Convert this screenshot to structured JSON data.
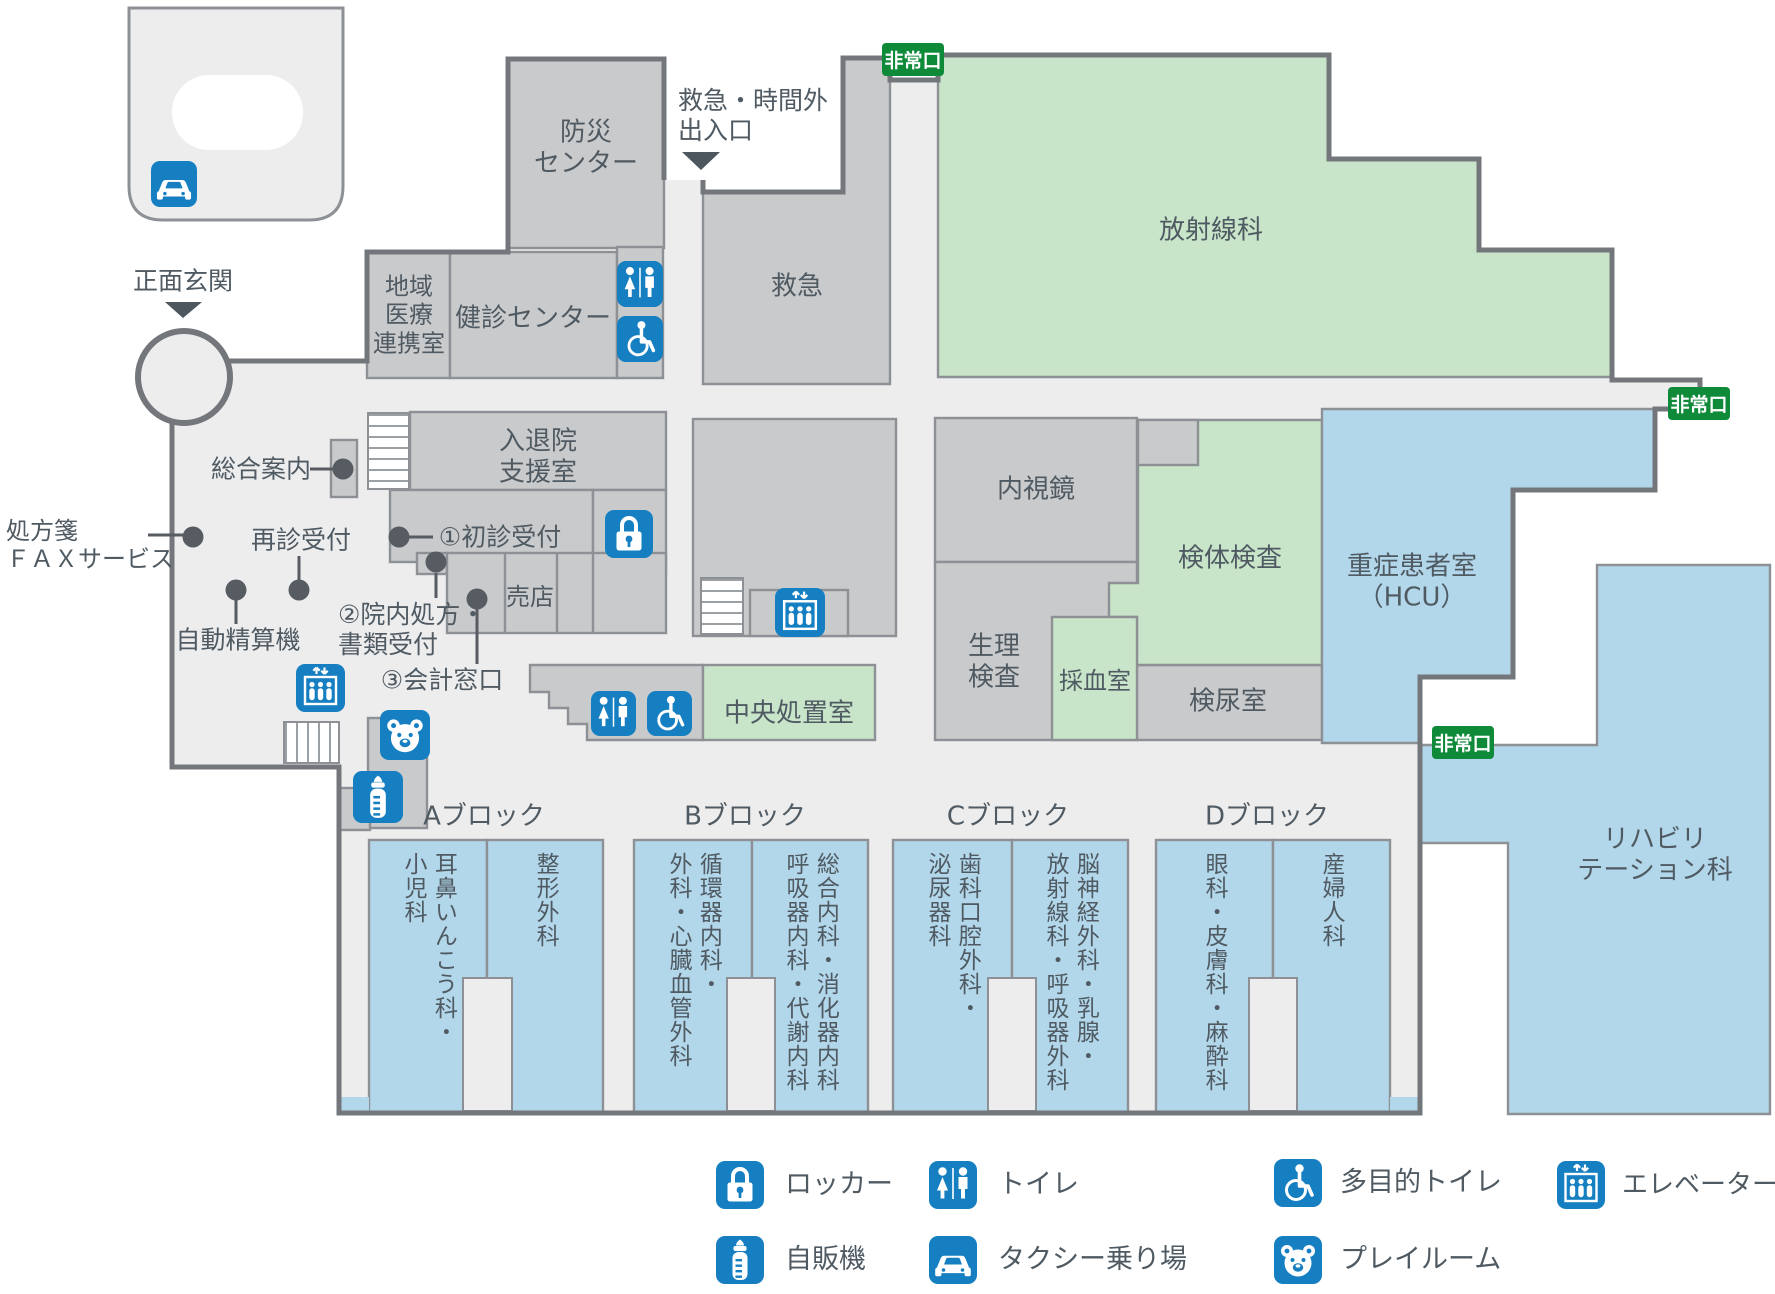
{
  "badge": {
    "exit": "非常口"
  },
  "entrances": {
    "main": {
      "label": "正面玄関"
    },
    "emergency": {
      "lines": [
        "救急・時間外",
        "出入口"
      ]
    }
  },
  "rooms": {
    "bousai": {
      "lines": [
        "防災",
        "センター"
      ]
    },
    "chiiki": {
      "lines": [
        "地域",
        "医療",
        "連携室"
      ]
    },
    "kenshin": {
      "label": "健診センター"
    },
    "kyukyu": {
      "label": "救急"
    },
    "housha": {
      "label": "放射線科"
    },
    "nyutaiin": {
      "lines": [
        "入退院",
        "支援室"
      ]
    },
    "baiten": {
      "label": "売店"
    },
    "naishikyo": {
      "label": "内視鏡"
    },
    "kentai": {
      "label": "検体検査"
    },
    "seiri": {
      "lines": [
        "生理",
        "検査"
      ]
    },
    "saiketsu": {
      "label": "採血室"
    },
    "kennyo": {
      "label": "検尿室"
    },
    "hcu": {
      "lines": [
        "重症患者室",
        "（HCU）"
      ]
    },
    "chuo": {
      "label": "中央処置室"
    },
    "rehab": {
      "lines": [
        "リハビリ",
        "テーション科"
      ]
    }
  },
  "annotations": {
    "sogo": {
      "label": "総合案内"
    },
    "fax": {
      "lines": [
        "処方箋",
        "ＦＡＸサービス"
      ]
    },
    "saishin": {
      "label": "再診受付"
    },
    "seisanki": {
      "label": "自動精算機"
    },
    "shoshin": {
      "label": "①初診受付"
    },
    "shohou": {
      "lines": [
        "②院内処方・",
        "書類受付"
      ]
    },
    "kaikei": {
      "label": "③会計窓口"
    }
  },
  "blocks": [
    {
      "label": "Aブロック",
      "columns": [
        {
          "lines": [
            "耳鼻いんこう科・",
            "小児科"
          ]
        },
        {
          "lines": [
            "整形外科"
          ]
        }
      ]
    },
    {
      "label": "Bブロック",
      "columns": [
        {
          "lines": [
            "循環器内科・",
            "外科・心臓血管外科"
          ]
        },
        {
          "lines": [
            "総合内科・消化器内科",
            "呼吸器内科・代謝内科"
          ]
        }
      ]
    },
    {
      "label": "Cブロック",
      "columns": [
        {
          "lines": [
            "歯科口腔外科・",
            "泌尿器科"
          ]
        },
        {
          "lines": [
            "脳神経外科・乳腺・",
            "放射線科・呼吸器外科"
          ]
        }
      ]
    },
    {
      "label": "Dブロック",
      "columns": [
        {
          "lines": [
            "眼科・皮膚科・麻酔科"
          ]
        },
        {
          "lines": [
            "産婦人科"
          ]
        }
      ]
    }
  ],
  "legend": {
    "items": [
      {
        "icon": "locker-icon",
        "label": "ロッカー"
      },
      {
        "icon": "toilet-icon",
        "label": "トイレ"
      },
      {
        "icon": "accessible-toilet-icon",
        "label": "多目的トイレ"
      },
      {
        "icon": "elevator-icon",
        "label": "エレベーター"
      },
      {
        "icon": "vending-machine-icon",
        "label": "自販機"
      },
      {
        "icon": "taxi-stand-icon",
        "label": "タクシー乗り場"
      },
      {
        "icon": "playroom-icon",
        "label": "プレイルーム"
      }
    ]
  },
  "map_icon_names": [
    "toilet-icon",
    "accessible-toilet-icon",
    "elevator-icon",
    "locker-icon",
    "vending-machine-icon",
    "taxi-stand-icon",
    "playroom-icon",
    "nursing-bottle-icon",
    "stairs-icon"
  ],
  "colors": {
    "icon_blue": "#157fc1",
    "exit_green": "#0e8a39",
    "room_gray": "#c9cacb",
    "room_green": "#c8e4c9",
    "room_blue": "#b3d7ea",
    "floor": "#ededee"
  }
}
